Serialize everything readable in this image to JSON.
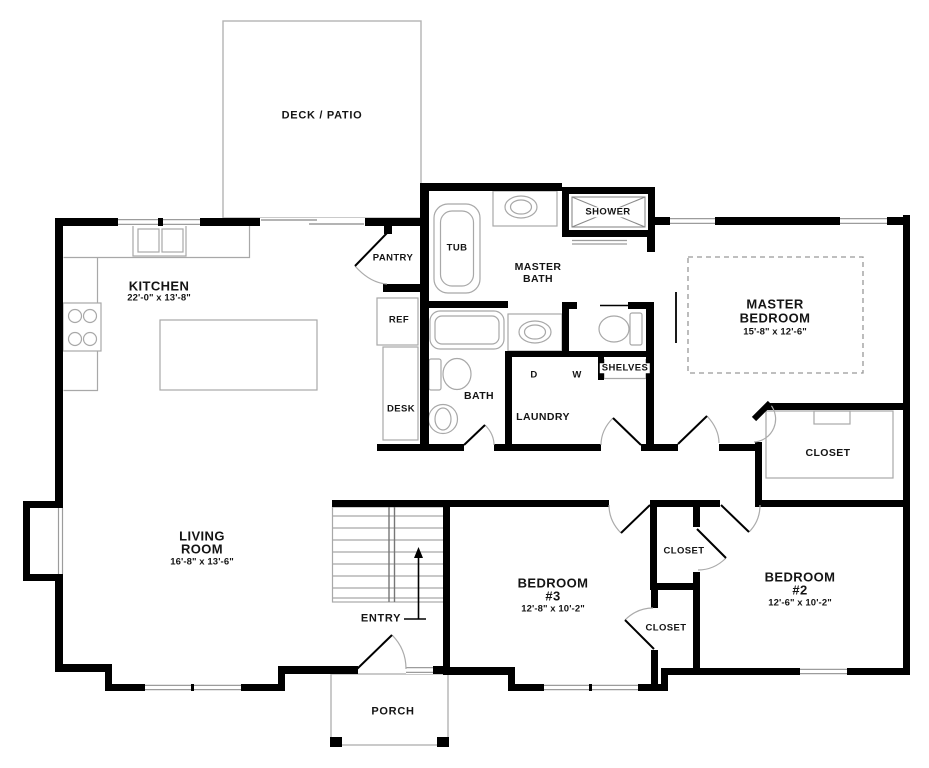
{
  "title": "Floor plan",
  "colors": {
    "wall": "#000000",
    "fixture_line": "#a8a8a8",
    "dashed_line": "#999999",
    "text": "#141414",
    "background": "#ffffff"
  },
  "labels": {
    "deck_patio": "DECK / PATIO",
    "kitchen": "KITCHEN",
    "kitchen_dims": "22'-0\" x 13'-8\"",
    "pantry": "PANTRY",
    "tub": "TUB",
    "master_bath_line1": "MASTER",
    "master_bath_line2": "BATH",
    "shower": "SHOWER",
    "ref": "REF",
    "desk": "DESK",
    "bath": "BATH",
    "dryer": "D",
    "washer": "W",
    "shelves": "SHELVES",
    "laundry": "LAUNDRY",
    "master_bedroom_line1": "MASTER",
    "master_bedroom_line2": "BEDROOM",
    "master_bedroom_dims": "15'-8\" x 12'-6\"",
    "master_closet": "CLOSET",
    "living_room_line1": "LIVING",
    "living_room_line2": "ROOM",
    "living_room_dims": "16'-8\" x 13'-6\"",
    "entry": "ENTRY",
    "bedroom3_line1": "BEDROOM",
    "bedroom3_line2": "#3",
    "bedroom3_dims": "12'-8\" x 10'-2\"",
    "closet_between_top": "CLOSET",
    "closet_between_bottom": "CLOSET",
    "bedroom2_line1": "BEDROOM",
    "bedroom2_line2": "#2",
    "bedroom2_dims": "12'-6\" x 10'-2\"",
    "porch": "PORCH"
  }
}
